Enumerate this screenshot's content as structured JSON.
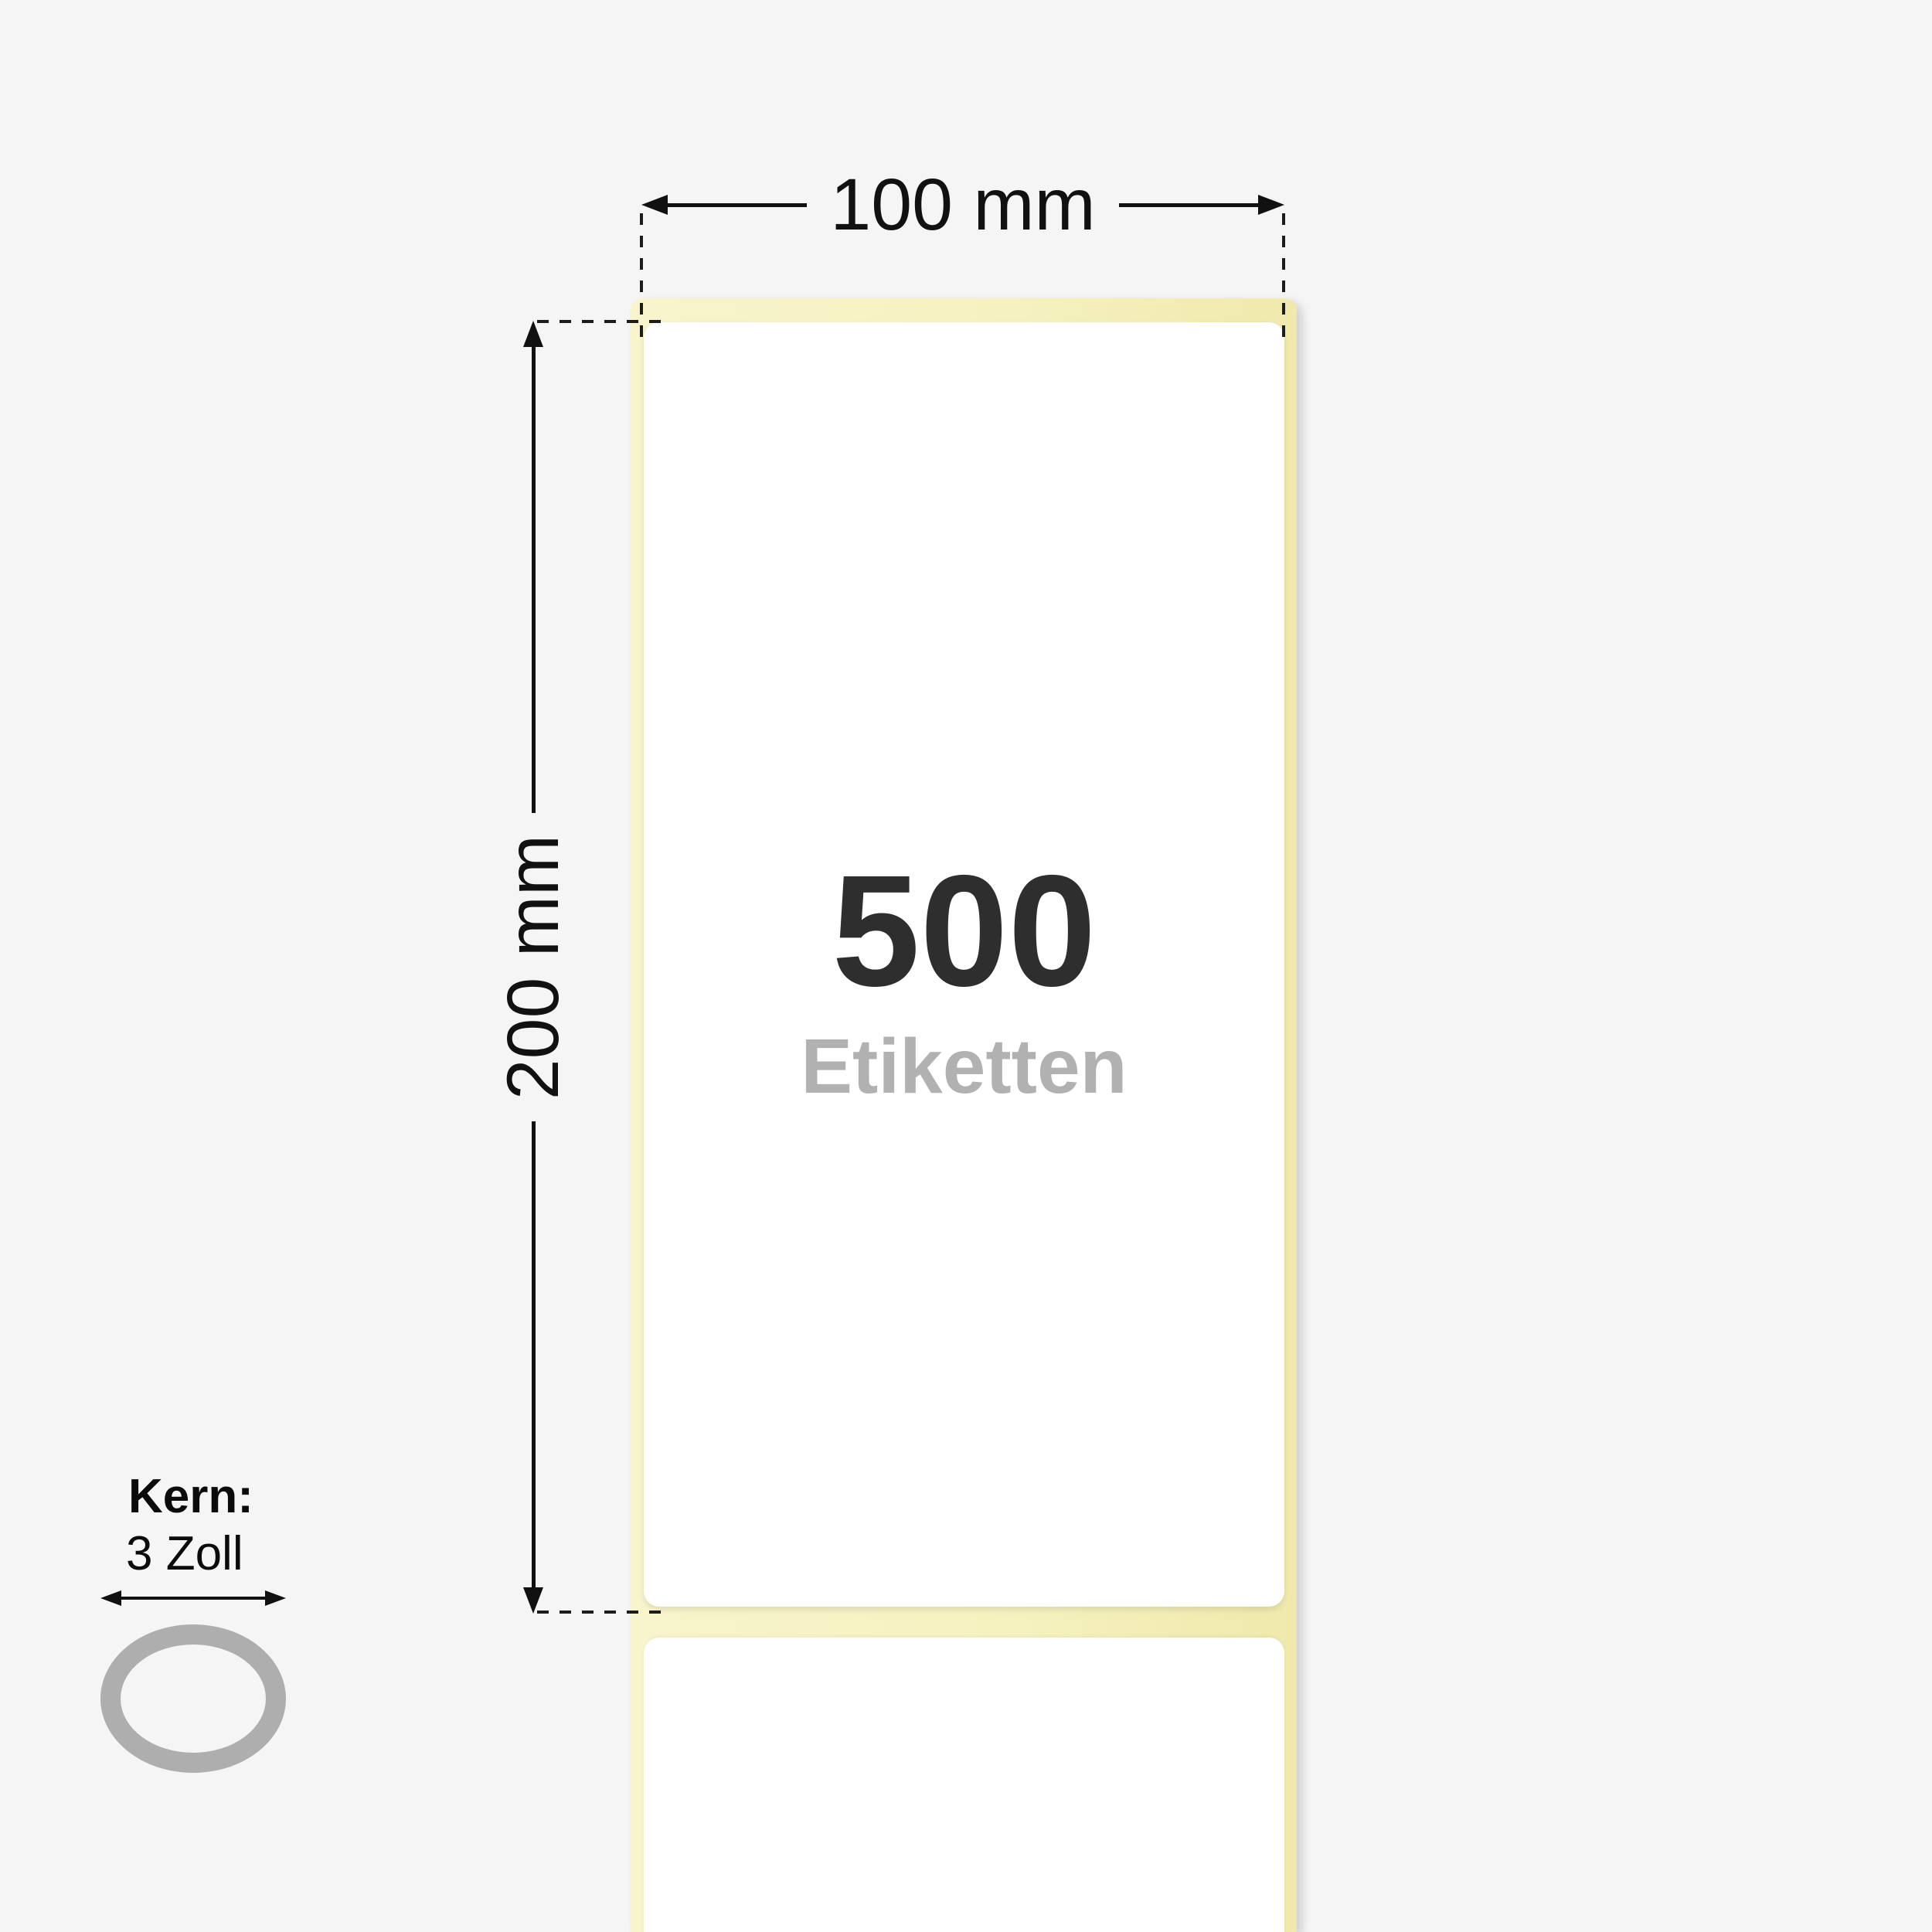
{
  "page": {
    "background_color": "#f5f5f6",
    "description": "Label roll dimension illustration"
  },
  "label_roll": {
    "count": "500",
    "count_unit": "Etiketten",
    "width_dimension": "100 mm",
    "height_dimension": "200 mm",
    "liner_color": "#f6f2c0",
    "label_color": "#ffffff"
  },
  "core": {
    "label": "Kern:",
    "value": "3 Zoll",
    "ring_color": "#aeaeae"
  },
  "style": {
    "dimension_line_color": "#111111",
    "count_text_color": "#2e2e2e",
    "unit_text_color": "#b1b1b1"
  }
}
